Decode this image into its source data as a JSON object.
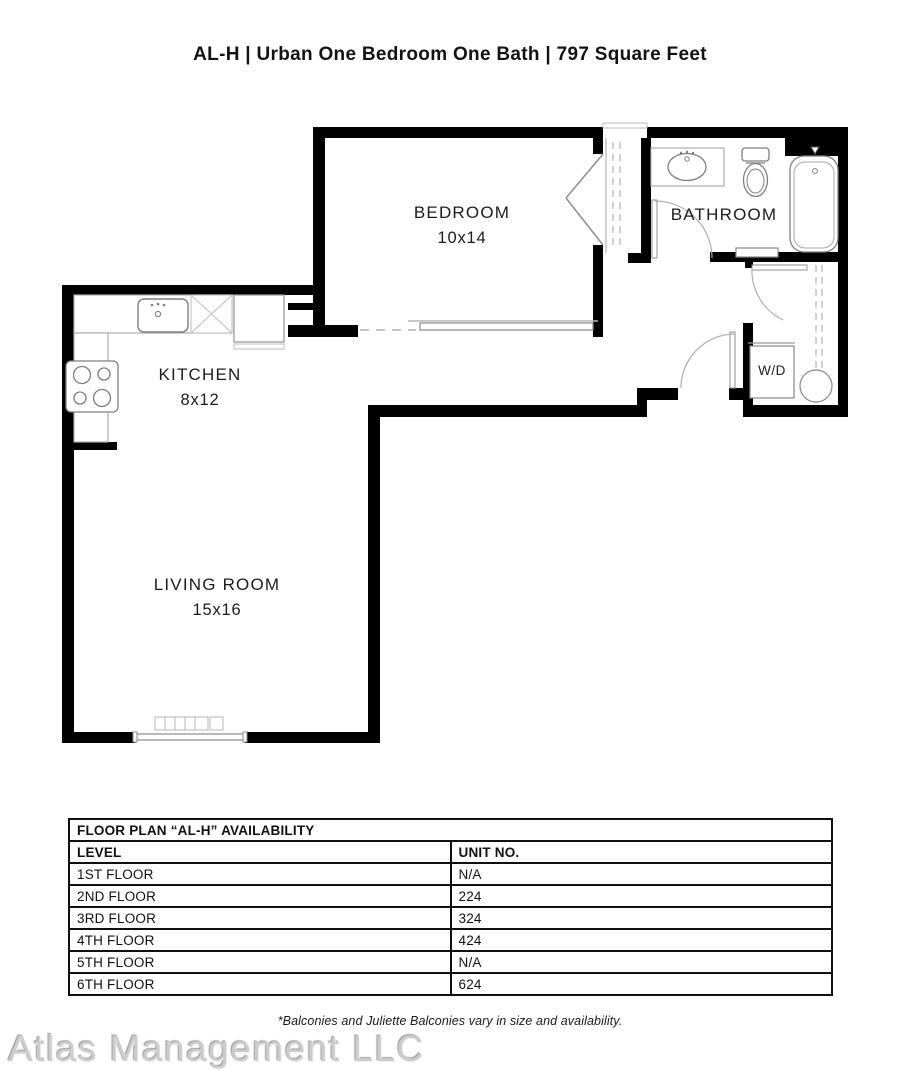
{
  "title": "AL-H | Urban One Bedroom One Bath | 797 Square Feet",
  "rooms": {
    "bedroom": {
      "name": "BEDROOM",
      "dims": "10x14"
    },
    "bathroom": {
      "name": "BATHROOM"
    },
    "kitchen": {
      "name": "KITCHEN",
      "dims": "8x12"
    },
    "living_room": {
      "name": "LIVING ROOM",
      "dims": "15x16"
    },
    "laundry": {
      "name": "W/D"
    }
  },
  "availability_table": {
    "title": "FLOOR PLAN “AL-H” AVAILABILITY",
    "columns": [
      "LEVEL",
      "UNIT NO."
    ],
    "rows": [
      [
        "1ST FLOOR",
        "N/A"
      ],
      [
        "2ND FLOOR",
        "224"
      ],
      [
        "3RD FLOOR",
        "324"
      ],
      [
        "4TH FLOOR",
        "424"
      ],
      [
        "5TH FLOOR",
        "N/A"
      ],
      [
        "6TH FLOOR",
        "624"
      ]
    ]
  },
  "footnote": "*Balconies and Juliette Balconies vary in size and availability.",
  "watermark": "Atlas Management LLC",
  "colors": {
    "wall": "#000000",
    "fixture_line": "#8a8a8a",
    "dash_line": "#c4c4c4"
  }
}
